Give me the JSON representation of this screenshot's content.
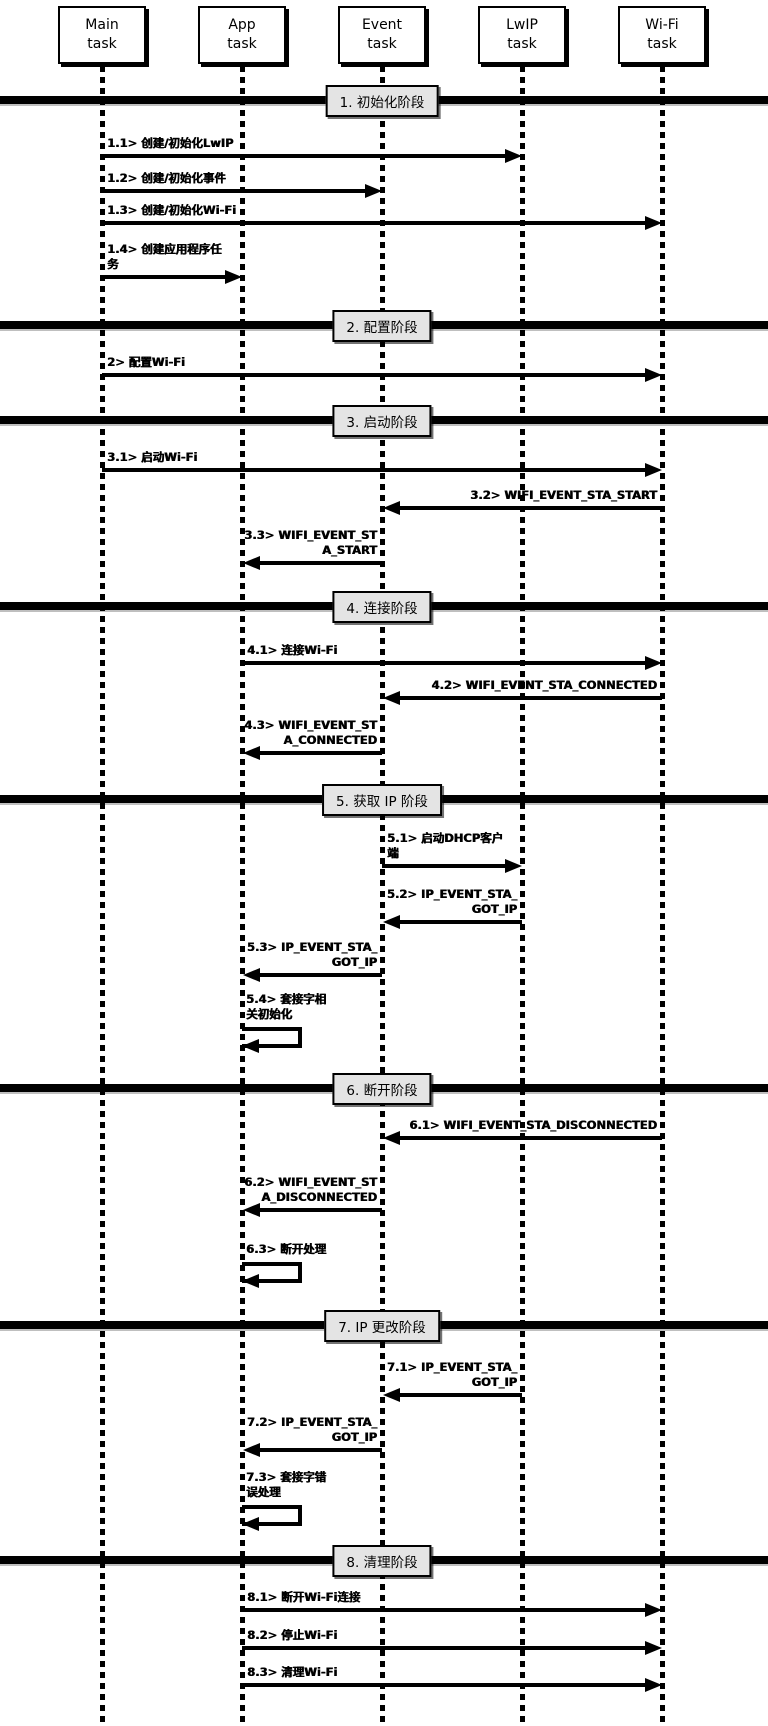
{
  "diagram_title": "",
  "colors": {
    "line": "#000000",
    "phase_fill": "#e4e4e4",
    "background": "#ffffff",
    "text": "#000000"
  },
  "lifelines": [
    {
      "id": "main",
      "line1": "Main",
      "line2": "task"
    },
    {
      "id": "app",
      "line1": "App",
      "line2": "task"
    },
    {
      "id": "event",
      "line1": "Event",
      "line2": "task"
    },
    {
      "id": "lwip",
      "line1": "LwIP",
      "line2": "task"
    },
    {
      "id": "wifi",
      "line1": "Wi-Fi",
      "line2": "task"
    }
  ],
  "phases": [
    {
      "label": "1. 初始化阶段",
      "y": 100
    },
    {
      "label": "2. 配置阶段",
      "y": 325
    },
    {
      "label": "3. 启动阶段",
      "y": 420
    },
    {
      "label": "4. 连接阶段",
      "y": 606
    },
    {
      "label": "5. 获取 IP 阶段",
      "y": 799
    },
    {
      "label": "6. 断开阶段",
      "y": 1088
    },
    {
      "label": "7. IP 更改阶段",
      "y": 1325
    },
    {
      "label": "8. 清理阶段",
      "y": 1560
    }
  ],
  "messages": [
    {
      "id": "1.1",
      "lines": [
        "1.1> 创建/初始化LwIP"
      ],
      "from": "main",
      "to": "lwip",
      "y": 156
    },
    {
      "id": "1.2",
      "lines": [
        "1.2> 创建/初始化事件"
      ],
      "from": "main",
      "to": "event",
      "y": 191
    },
    {
      "id": "1.3",
      "lines": [
        "1.3> 创建/初始化Wi-Fi"
      ],
      "from": "main",
      "to": "wifi",
      "y": 223
    },
    {
      "id": "1.4",
      "lines": [
        "1.4> 创建应用程序任",
        "务"
      ],
      "from": "main",
      "to": "app",
      "y": 277
    },
    {
      "id": "2",
      "lines": [
        "2> 配置Wi-Fi"
      ],
      "from": "main",
      "to": "wifi",
      "y": 375
    },
    {
      "id": "3.1",
      "lines": [
        "3.1> 启动Wi-Fi"
      ],
      "from": "main",
      "to": "wifi",
      "y": 470
    },
    {
      "id": "3.2",
      "lines": [
        "3.2> WIFI_EVENT_STA_START"
      ],
      "from": "wifi",
      "to": "event",
      "y": 508
    },
    {
      "id": "3.3",
      "lines": [
        "3.3> WIFI_EVENT_ST",
        "A_START"
      ],
      "from": "event",
      "to": "app",
      "y": 563
    },
    {
      "id": "4.1",
      "lines": [
        "4.1> 连接Wi-Fi"
      ],
      "from": "app",
      "to": "wifi",
      "y": 663
    },
    {
      "id": "4.2",
      "lines": [
        "4.2> WIFI_EVENT_STA_CONNECTED"
      ],
      "from": "wifi",
      "to": "event",
      "y": 698
    },
    {
      "id": "4.3",
      "lines": [
        "4.3> WIFI_EVENT_ST",
        "A_CONNECTED"
      ],
      "from": "event",
      "to": "app",
      "y": 753
    },
    {
      "id": "5.1",
      "lines": [
        "5.1> 启动DHCP客户",
        "端"
      ],
      "from": "event",
      "to": "lwip",
      "y": 866
    },
    {
      "id": "5.2",
      "lines": [
        "5.2> IP_EVENT_STA_",
        "GOT_IP"
      ],
      "from": "lwip",
      "to": "event",
      "y": 922
    },
    {
      "id": "5.3",
      "lines": [
        "5.3> IP_EVENT_STA_",
        "GOT_IP"
      ],
      "from": "event",
      "to": "app",
      "y": 975
    },
    {
      "id": "5.4",
      "lines": [
        "5.4> 套接字相",
        "关初始化"
      ],
      "self": "app",
      "y": 1027
    },
    {
      "id": "6.1",
      "lines": [
        "6.1> WIFI_EVENT_STA_DISCONNECTED"
      ],
      "from": "wifi",
      "to": "event",
      "y": 1138
    },
    {
      "id": "6.2",
      "lines": [
        "6.2> WIFI_EVENT_ST",
        "A_DISCONNECTED"
      ],
      "from": "event",
      "to": "app",
      "y": 1210
    },
    {
      "id": "6.3",
      "lines": [
        "6.3> 断开处理"
      ],
      "self": "app",
      "y": 1262
    },
    {
      "id": "7.1",
      "lines": [
        "7.1> IP_EVENT_STA_",
        "GOT_IP"
      ],
      "from": "lwip",
      "to": "event",
      "y": 1395
    },
    {
      "id": "7.2",
      "lines": [
        "7.2> IP_EVENT_STA_",
        "GOT_IP"
      ],
      "from": "event",
      "to": "app",
      "y": 1450
    },
    {
      "id": "7.3",
      "lines": [
        "7.3> 套接字错",
        "误处理"
      ],
      "self": "app",
      "y": 1505
    },
    {
      "id": "8.1",
      "lines": [
        "8.1> 断开Wi-Fi连接"
      ],
      "from": "app",
      "to": "wifi",
      "y": 1610
    },
    {
      "id": "8.2",
      "lines": [
        "8.2> 停止Wi-Fi"
      ],
      "from": "app",
      "to": "wifi",
      "y": 1648
    },
    {
      "id": "8.3",
      "lines": [
        "8.3> 清理Wi-Fi"
      ],
      "from": "app",
      "to": "wifi",
      "y": 1685
    }
  ]
}
